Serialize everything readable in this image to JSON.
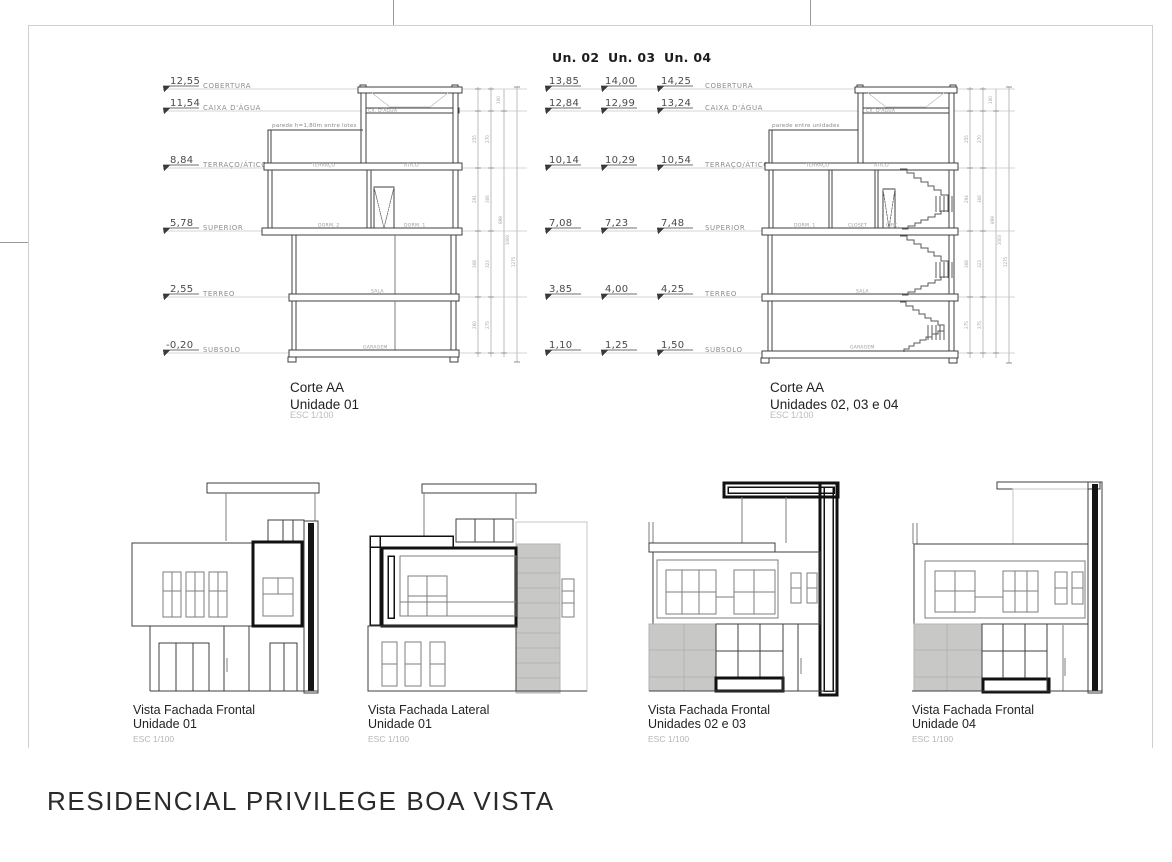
{
  "title": "RESIDENCIAL PRIVILEGE BOA VISTA",
  "colors": {
    "drawing_line": "#3f3f3f",
    "facade_gray": "#c8c8c6",
    "highlight_black": "#111111"
  },
  "corte1": {
    "caption": {
      "line1": "Corte AA",
      "line2": "Unidade 01",
      "scale": "ESC 1/100"
    },
    "note": "parede h=1,80m entre lotes",
    "levels": [
      {
        "value": "12,55",
        "name": "COBERTURA"
      },
      {
        "value": "11,54",
        "name": "CAIXA D'ÁGUA"
      },
      {
        "value": "8,84",
        "name": "TERRAÇO/ÁTICO"
      },
      {
        "value": "5,78",
        "name": "SUPERIOR"
      },
      {
        "value": "2,55",
        "name": "TERREO"
      },
      {
        "value": "-0,20",
        "name": "SUBSOLO"
      }
    ],
    "rooms": {
      "cx": "CX. D'ÁGUA",
      "terraco": "TERRAÇO",
      "atico": "ÁTICO",
      "dorm2": "DORM. 2",
      "dorm1": "DORM. 1",
      "sala": "SALA",
      "garagem": "GARAGEM"
    },
    "dims": {
      "col1": [
        "255",
        "291",
        "308",
        "260"
      ],
      "col2": [
        "270",
        "306",
        "323",
        "275"
      ],
      "col3": [
        "899",
        "100"
      ],
      "col4": [
        "1000"
      ],
      "col5": [
        "1275"
      ]
    }
  },
  "corte2": {
    "units": [
      "Un. 02",
      "Un. 03",
      "Un. 04"
    ],
    "caption": {
      "line1": "Corte AA",
      "line2": "Unidades 02, 03 e 04",
      "scale": "ESC 1/100"
    },
    "note": "parede entre unidades",
    "levels": [
      {
        "values": [
          "13,85",
          "14,00",
          "14,25"
        ],
        "name": "COBERTURA"
      },
      {
        "values": [
          "12,84",
          "12,99",
          "13,24"
        ],
        "name": "CAIXA D'ÁGUA"
      },
      {
        "values": [
          "10,14",
          "10,29",
          "10,54"
        ],
        "name": "TERRAÇO/ÁTICO"
      },
      {
        "values": [
          "7,08",
          "7,23",
          "7,48"
        ],
        "name": "SUPERIOR"
      },
      {
        "values": [
          "3,85",
          "4,00",
          "4,25"
        ],
        "name": "TERREO"
      },
      {
        "values": [
          "1,10",
          "1,25",
          "1,50"
        ],
        "name": "SUBSOLO"
      }
    ],
    "rooms": {
      "cx": "CX. D'ÁGUA",
      "terraco": "TERRAÇO",
      "atico": "ÁTICO",
      "dorm1": "DORM. 1",
      "closet": "CLOSET",
      "circ": "CIRC.",
      "sala": "SALA",
      "garagem": "GARAGEM"
    },
    "dims": {
      "col1": [
        "255",
        "294",
        "308",
        "275"
      ],
      "col2": [
        "270",
        "306",
        "323",
        "275"
      ],
      "col3": [
        "899",
        "100"
      ],
      "col4": [
        "1003"
      ],
      "col5": [
        "1275"
      ]
    }
  },
  "facades": [
    {
      "line1": "Vista Fachada Frontal",
      "line2": "Unidade 01",
      "scale": "ESC 1/100"
    },
    {
      "line1": "Vista Fachada Lateral",
      "line2": "Unidade 01",
      "scale": "ESC 1/100"
    },
    {
      "line1": "Vista Fachada Frontal",
      "line2": "Unidades 02 e 03",
      "scale": "ESC 1/100"
    },
    {
      "line1": "Vista Fachada Frontal",
      "line2": "Unidade 04",
      "scale": "ESC 1/100"
    }
  ]
}
